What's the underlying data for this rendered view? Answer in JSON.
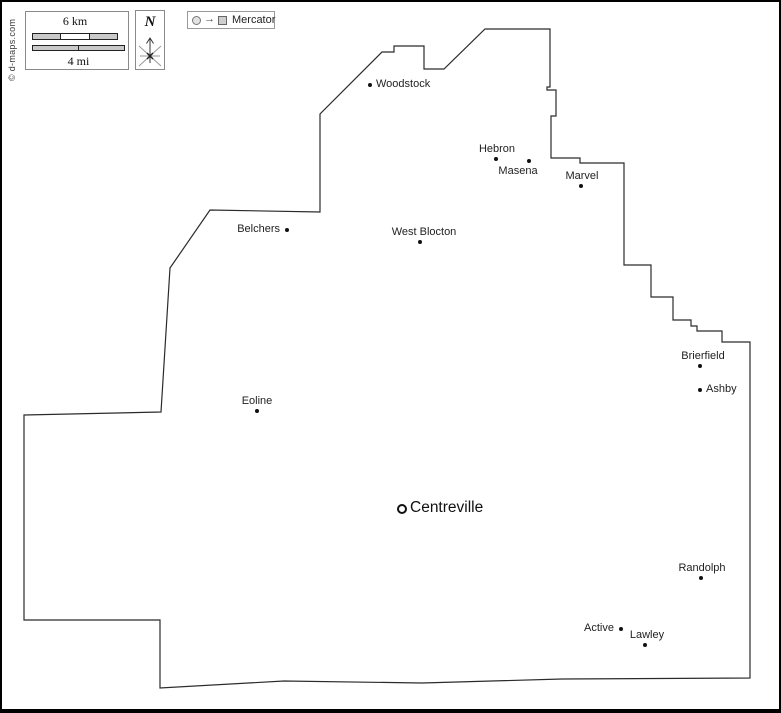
{
  "meta": {
    "copyright": "© d-maps.com"
  },
  "scale": {
    "km_label": "6 km",
    "mi_label": "4 mi"
  },
  "compass": {
    "north_label": "N"
  },
  "legend": {
    "projection_label": "Mercator"
  },
  "colors": {
    "outline": "#2b2b2b",
    "bar_fill": "#c9c9c9",
    "legend_square_fill": "#cfcfcf",
    "text": "#1f1f1f",
    "background": "#ffffff"
  },
  "towns": [
    {
      "name": "Woodstock",
      "x": 368,
      "y": 83,
      "marker": "dot",
      "label_pos": "right",
      "dx": 0
    },
    {
      "name": "Hebron",
      "x": 494,
      "y": 157,
      "marker": "dot",
      "label_pos": "above",
      "dx": 1
    },
    {
      "name": "Masena",
      "x": 527,
      "y": 159,
      "marker": "dot",
      "label_pos": "below",
      "dx": -11
    },
    {
      "name": "Marvel",
      "x": 579,
      "y": 184,
      "marker": "dot",
      "label_pos": "above",
      "dx": 1
    },
    {
      "name": "Belchers",
      "x": 285,
      "y": 228,
      "marker": "dot",
      "label_pos": "left",
      "dx": 0
    },
    {
      "name": "West Blocton",
      "x": 418,
      "y": 240,
      "marker": "dot",
      "label_pos": "above",
      "dx": 4
    },
    {
      "name": "Eoline",
      "x": 255,
      "y": 409,
      "marker": "dot",
      "label_pos": "above",
      "dx": 0
    },
    {
      "name": "Centreville",
      "x": 400,
      "y": 507,
      "marker": "ring",
      "label_pos": "right",
      "dx": 0,
      "big": true
    },
    {
      "name": "Brierfield",
      "x": 698,
      "y": 364,
      "marker": "dot",
      "label_pos": "above",
      "dx": 3
    },
    {
      "name": "Ashby",
      "x": 698,
      "y": 388,
      "marker": "dot",
      "label_pos": "right",
      "dx": 0
    },
    {
      "name": "Randolph",
      "x": 699,
      "y": 576,
      "marker": "dot",
      "label_pos": "above",
      "dx": 1
    },
    {
      "name": "Active",
      "x": 619,
      "y": 627,
      "marker": "dot",
      "label_pos": "left",
      "dx": 0
    },
    {
      "name": "Lawley",
      "x": 643,
      "y": 643,
      "marker": "dot",
      "label_pos": "above",
      "dx": 2
    }
  ]
}
